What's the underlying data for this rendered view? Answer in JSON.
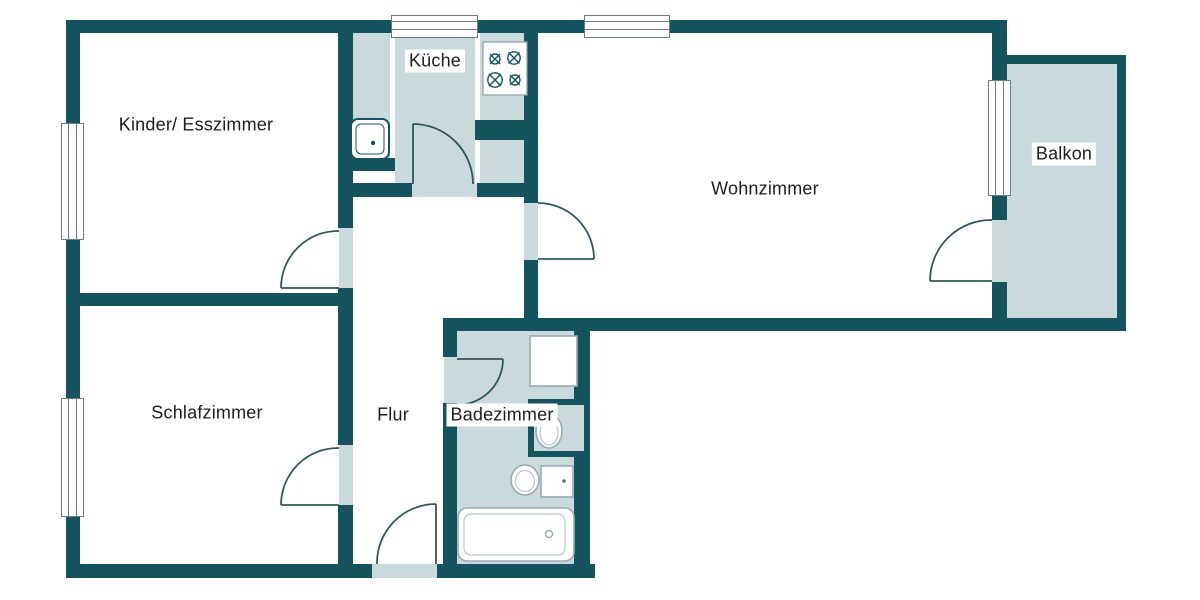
{
  "plan_title": "Apartment floor plan",
  "colors": {
    "wall": "#15545e",
    "accent": "#c9d9dc",
    "outline": "#30606a",
    "fixture": "#9aacb2",
    "arc": "#33565e",
    "text": "#1d1d1d",
    "bg": "#ffffff"
  },
  "rooms": {
    "kinder": {
      "label": "Kinder/ Esszimmer"
    },
    "kueche": {
      "label": "Küche"
    },
    "wohnzimmer": {
      "label": "Wohnzimmer"
    },
    "balkon": {
      "label": "Balkon"
    },
    "schlafzimmer": {
      "label": "Schlafzimmer"
    },
    "flur": {
      "label": "Flur"
    },
    "badezimmer": {
      "label": "Badezimmer"
    }
  }
}
